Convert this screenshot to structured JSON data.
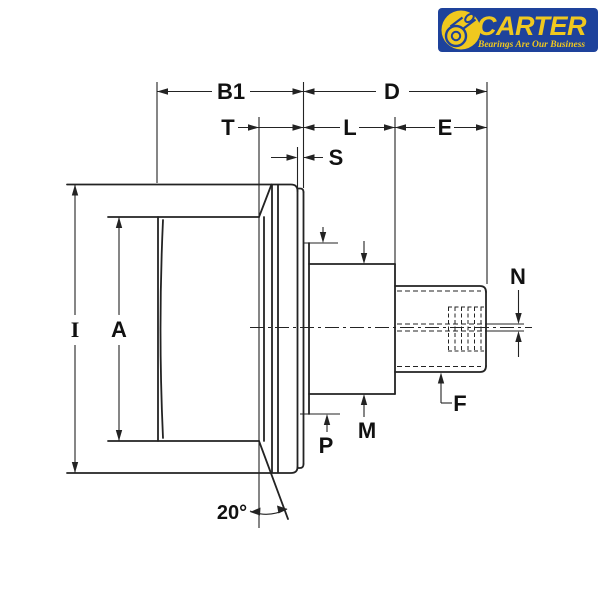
{
  "logo": {
    "brand": "CARTER",
    "tagline": "Bearings Are Our Business",
    "blue": "#1e429b",
    "yellow": "#f0c81f"
  },
  "diagram": {
    "angle_label": "20°",
    "dims": {
      "b1": "B1",
      "d": "D",
      "t": "T",
      "l": "L",
      "e": "E",
      "s": "S",
      "i": "I",
      "a": "A",
      "m": "M",
      "p": "P",
      "n": "N",
      "f": "F"
    },
    "line_color": "#232323",
    "background": "#ffffff"
  }
}
